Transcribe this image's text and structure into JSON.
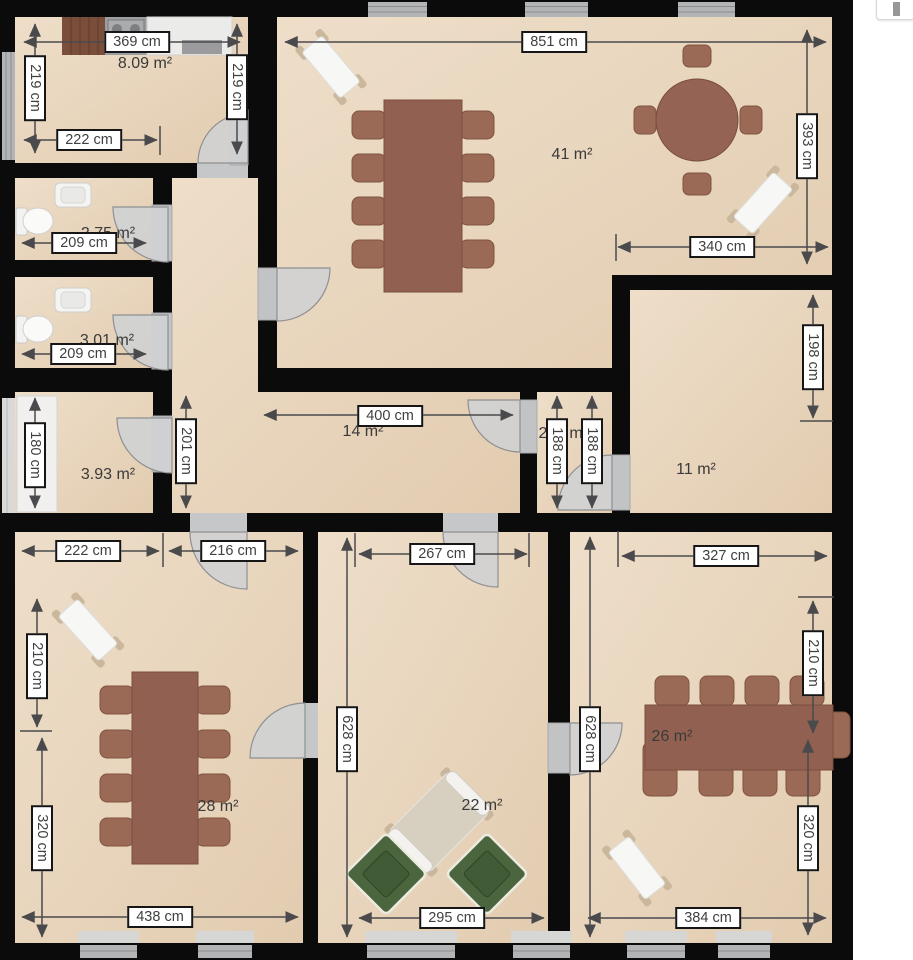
{
  "plan": {
    "areas": [
      {
        "id": "kitchen",
        "label": "8.09 m²"
      },
      {
        "id": "living-room",
        "label": "41 m²"
      },
      {
        "id": "wc-1",
        "label": "2.75 m²"
      },
      {
        "id": "wc-2",
        "label": "3.01 m²"
      },
      {
        "id": "storage",
        "label": "3.93 m²"
      },
      {
        "id": "hallway",
        "label": "14 m²"
      },
      {
        "id": "room-11",
        "label": "11 m²"
      },
      {
        "id": "room-28",
        "label": "28 m²"
      },
      {
        "id": "room-22",
        "label": "22 m²"
      },
      {
        "id": "room-26",
        "label": "26 m²"
      },
      {
        "id": "vestibule",
        "fragment_left": "2",
        "fragment_right": "m"
      }
    ],
    "dimensions": [
      {
        "id": "kitchen-top-width",
        "label": "369 cm"
      },
      {
        "id": "kitchen-left-height",
        "label": "219 cm"
      },
      {
        "id": "kitchen-right-height",
        "label": "219 cm"
      },
      {
        "id": "kitchen-inner-width",
        "label": "222 cm"
      },
      {
        "id": "living-top-width",
        "label": "851 cm"
      },
      {
        "id": "living-right-height",
        "label": "393 cm"
      },
      {
        "id": "living-lower-width",
        "label": "340 cm"
      },
      {
        "id": "wc1-width",
        "label": "209 cm"
      },
      {
        "id": "wc2-width",
        "label": "209 cm"
      },
      {
        "id": "storage-height",
        "label": "180 cm"
      },
      {
        "id": "hall-height",
        "label": "201 cm"
      },
      {
        "id": "hall-width",
        "label": "400 cm"
      },
      {
        "id": "vestibule-height-a",
        "label": "188 cm"
      },
      {
        "id": "vestibule-height-b",
        "label": "188 cm"
      },
      {
        "id": "room11-height",
        "label": "198 cm"
      },
      {
        "id": "bottomleft-top-width-a",
        "label": "222 cm"
      },
      {
        "id": "bottomleft-top-width-b",
        "label": "216 cm"
      },
      {
        "id": "bottomleft-left-height-a",
        "label": "210 cm"
      },
      {
        "id": "bottomleft-left-height-b",
        "label": "320 cm"
      },
      {
        "id": "bottomleft-bottom-width",
        "label": "438 cm"
      },
      {
        "id": "bottommid-top-width",
        "label": "267 cm"
      },
      {
        "id": "bottommid-left-height",
        "label": "628 cm"
      },
      {
        "id": "bottommid-bottom-width",
        "label": "295 cm"
      },
      {
        "id": "bottomright-top-width",
        "label": "327 cm"
      },
      {
        "id": "bottomright-left-height",
        "label": "628 cm"
      },
      {
        "id": "bottomright-right-height-a",
        "label": "210 cm"
      },
      {
        "id": "bottomright-right-height-b",
        "label": "320 cm"
      },
      {
        "id": "bottomright-bottom-width",
        "label": "384 cm"
      }
    ],
    "colors": {
      "wall": "#0b0b0b",
      "floor": "#e9d6bf",
      "door": "#cfd0d3",
      "window": "#b3b4b6",
      "table": "#916050",
      "chair": "#9a6a56",
      "armchair": "#4c663e",
      "dimension_line": "#4a4a4c",
      "label_text": "#3f3f3f"
    }
  },
  "ui": {
    "partial_button": {
      "icon": "vertical-bar-icon"
    }
  }
}
